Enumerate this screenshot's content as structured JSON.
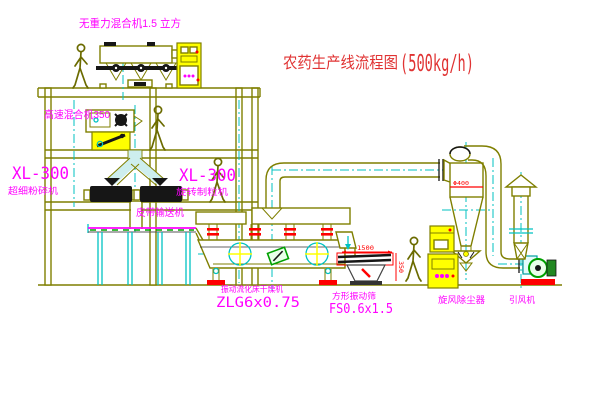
{
  "title": {
    "main": "农药生产线流程图",
    "capacity": "(500kg/h)"
  },
  "labels": {
    "gravity_mixer": "无重力混合机1.5 立方",
    "high_speed_mixer": "高速混合机350",
    "xl300_left": "XL-300",
    "pulverizer": "超细粉碎机",
    "xl300_right": "XL-300",
    "granulator": "旋转制粒机",
    "belt_conveyor": "皮带输送机",
    "dryer": "振动流化床干燥机",
    "dryer_model": "ZLG6x0.75",
    "square_screen": "方形振动筛",
    "screen_model": "FS0.6x1.5",
    "cyclone": "旋风除尘器",
    "fan": "引风机"
  },
  "dimensions": {
    "screen_length": "1500",
    "screen_height": "350",
    "cyclone_diameter": "Φ400"
  },
  "colors": {
    "line_olive": "#7f7f00",
    "centerline_cyan": "#00c2c2",
    "label_magenta": "#ff00ff",
    "title_red": "#e03333",
    "cabinet_yellow": "#ffff00",
    "flange_red": "#ff0000",
    "belt_green": "#00a000",
    "background": "#ffffff"
  }
}
